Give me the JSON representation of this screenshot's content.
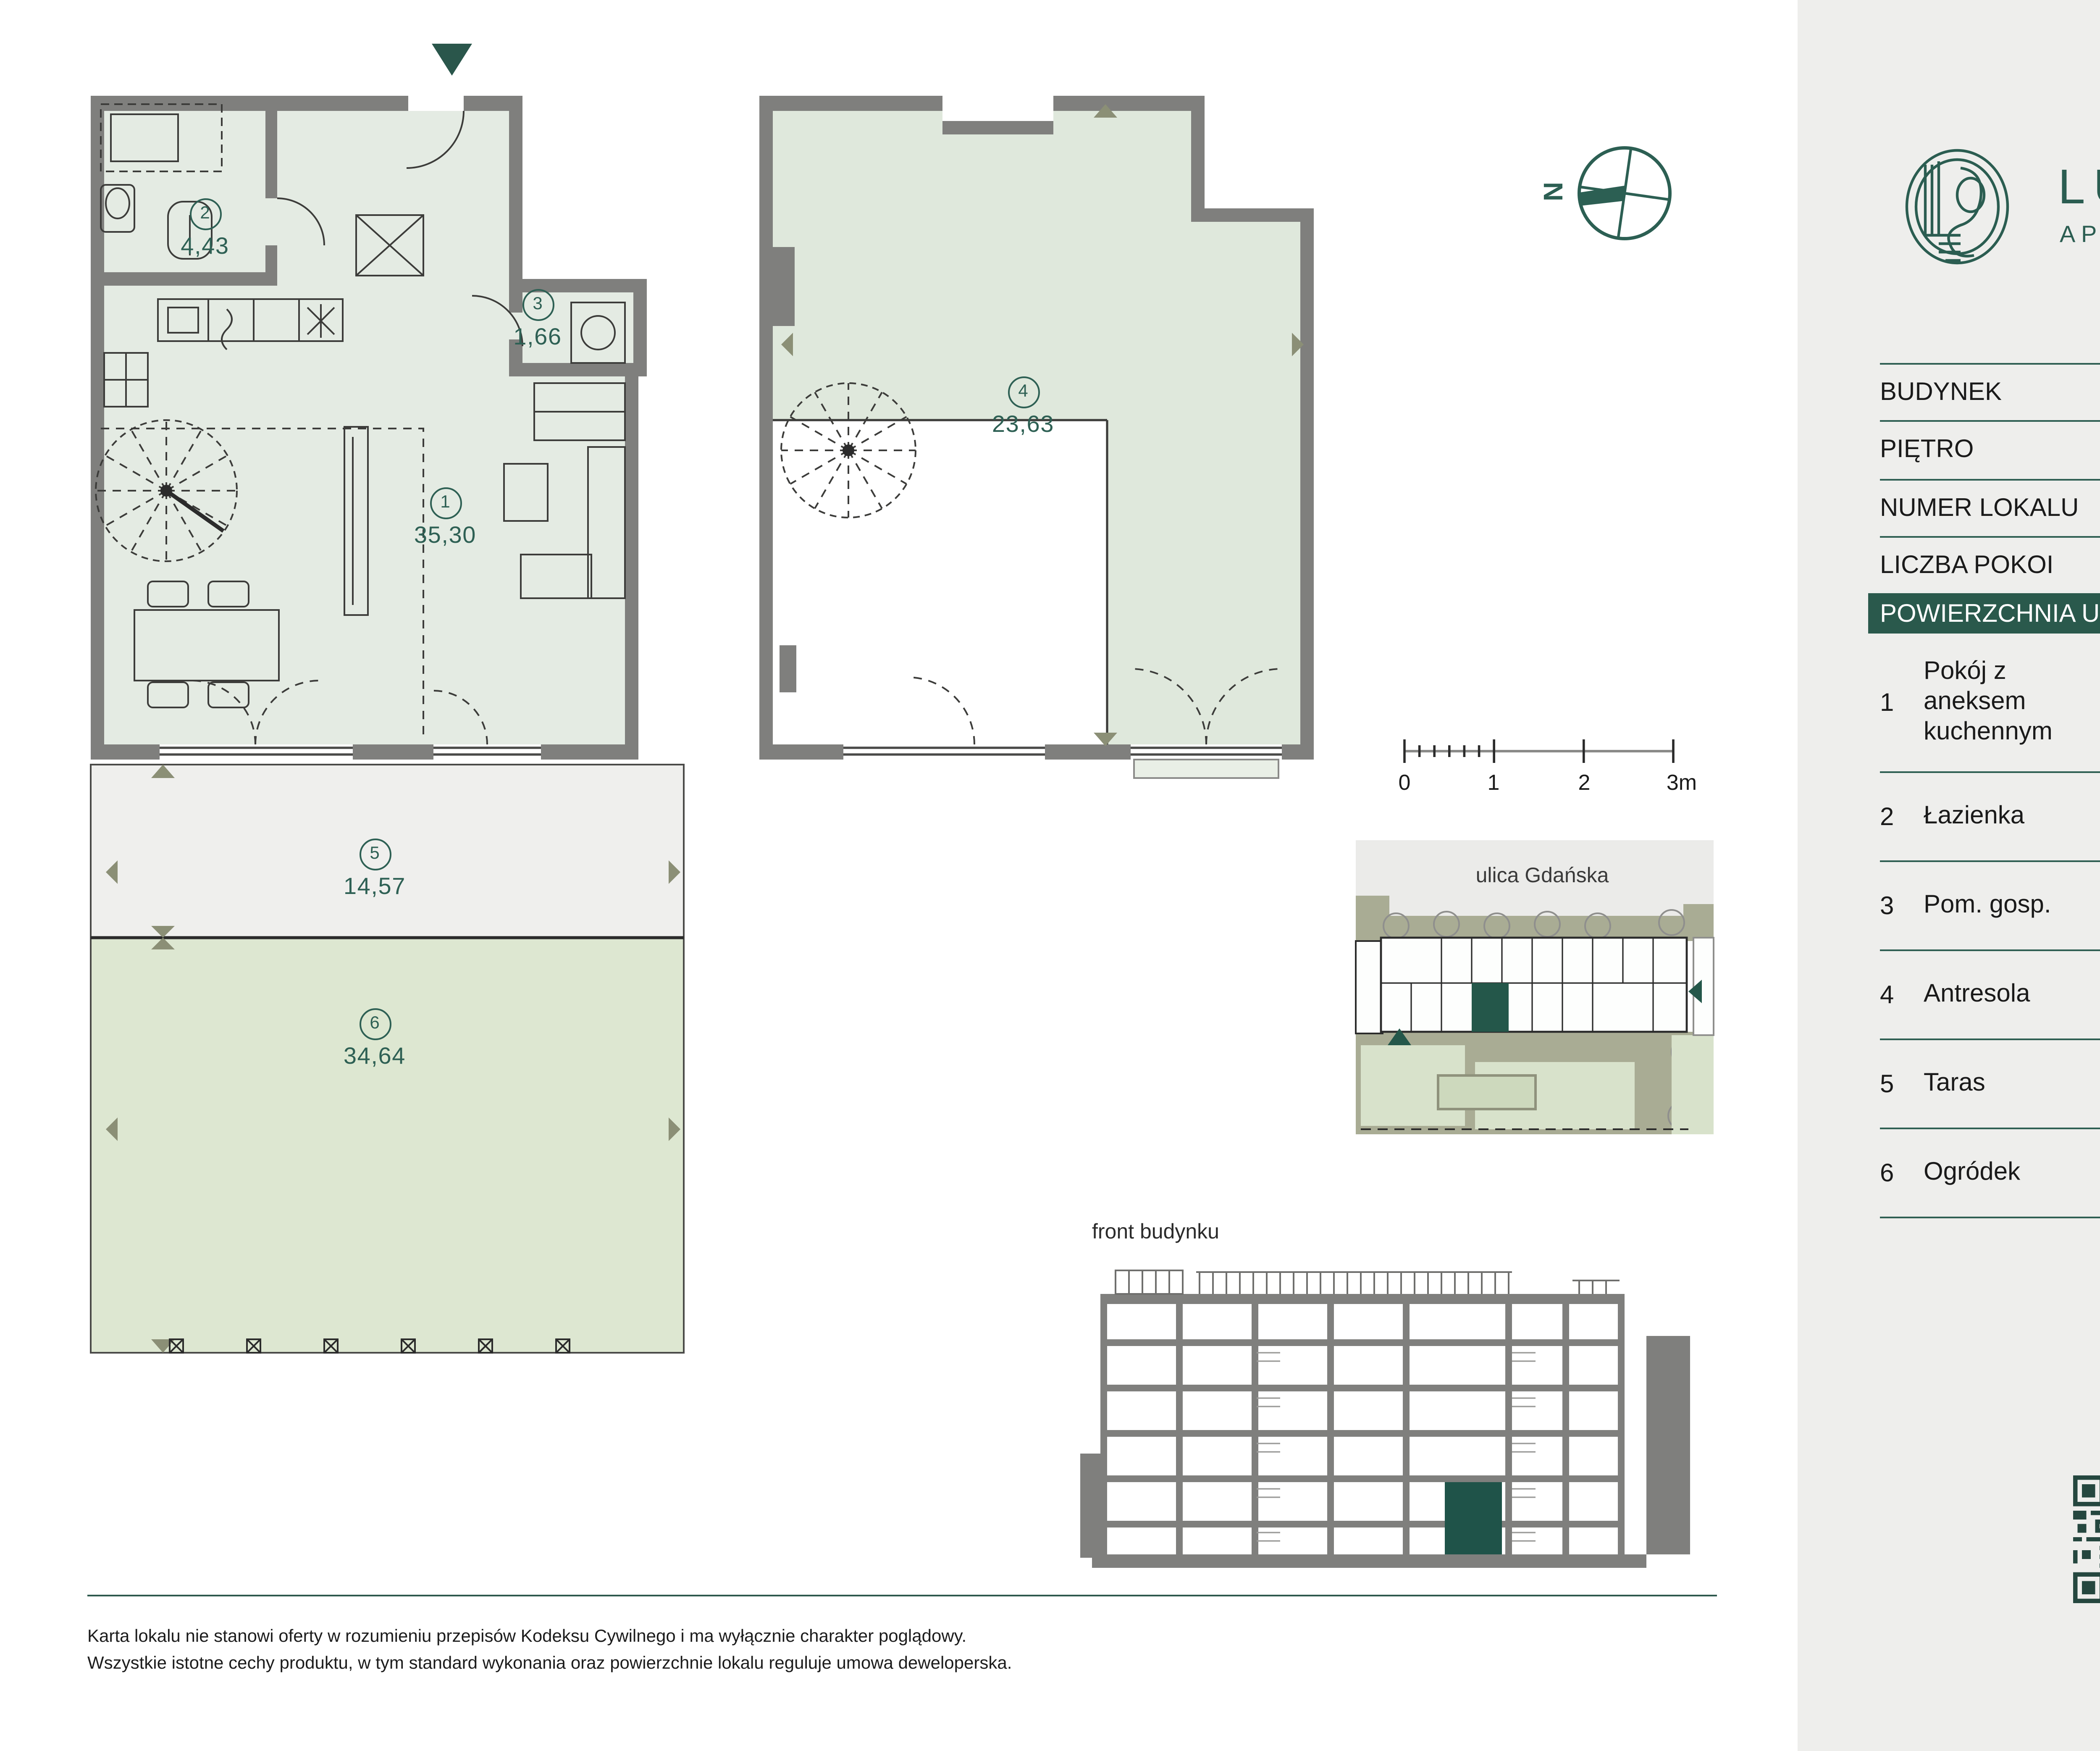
{
  "brand": {
    "name": "LUXSFERA",
    "subtitle": "APARTAMENTY"
  },
  "info": {
    "rows": [
      {
        "label": "BUDYNEK",
        "value": "A"
      },
      {
        "label": "PIĘTRO",
        "value": "PARTER"
      },
      {
        "label": "NUMER LOKALU",
        "value": "A2.0.2"
      },
      {
        "label": "LICZBA POKOI",
        "value": "IP + AK + AN"
      }
    ],
    "highlight": {
      "label": "POWIERZCHNIA UŻYTKOWA",
      "value": "65,02 m²"
    }
  },
  "rooms": [
    {
      "no": "1",
      "name": "Pokój z aneksem kuchennym",
      "dims": "6,43 x 7,26",
      "area": "35,30 m²"
    },
    {
      "no": "2",
      "name": "Łazienka",
      "dims": "2,38 x 1,94",
      "area": "4,43 m²"
    },
    {
      "no": "3",
      "name": "Pom. gosp.",
      "dims": "1,52 x 1,28",
      "area": "1,66 m²"
    },
    {
      "no": "4",
      "name": "Antresola",
      "dims": "6,43 x 7,26",
      "area": "23,63 m²"
    },
    {
      "no": "5",
      "name": "Taras",
      "dims": "6,94 x 2,10",
      "area": "14,57 m²"
    },
    {
      "no": "6",
      "name": "Ogródek",
      "dims": "6,90 x 5,02",
      "area": "34,64 m²"
    }
  ],
  "plan_labels": {
    "r1": {
      "no": "1",
      "area": "35,30"
    },
    "r2": {
      "no": "2",
      "area": "4,43"
    },
    "r3": {
      "no": "3",
      "area": "1,66"
    },
    "r4": {
      "no": "4",
      "area": "23,63"
    },
    "r5": {
      "no": "5",
      "area": "14,57"
    },
    "r6": {
      "no": "6",
      "area": "34,64"
    }
  },
  "compass": {
    "north": "N"
  },
  "scale_bar": {
    "ticks": [
      "0",
      "1",
      "2",
      "3m"
    ]
  },
  "site_plan": {
    "street": "ulica Gdańska"
  },
  "elevation": {
    "title": "front budynku"
  },
  "disclaimer": {
    "line1": "Karta lokalu nie stanowi oferty w rozumieniu przepisów Kodeksu Cywilnego i ma wyłącznie charakter poglądowy.",
    "line2": "Wszystkie istotne cechy produktu, w tym standard wykonania oraz powierzchnie lokalu reguluje umowa deweloperska."
  },
  "colors": {
    "brand_teal": "#2b5d51",
    "highlight_green": "#2a594c",
    "wall_gray": "#7f7f7d",
    "plan_fill": "#e4ebe3",
    "antresola_fill": "#dfe8dc",
    "terrace_fill": "#efefed",
    "garden_fill": "#dde7d1",
    "sidebar_bg": "#eeeeec",
    "site_highlight": "#24574a"
  }
}
